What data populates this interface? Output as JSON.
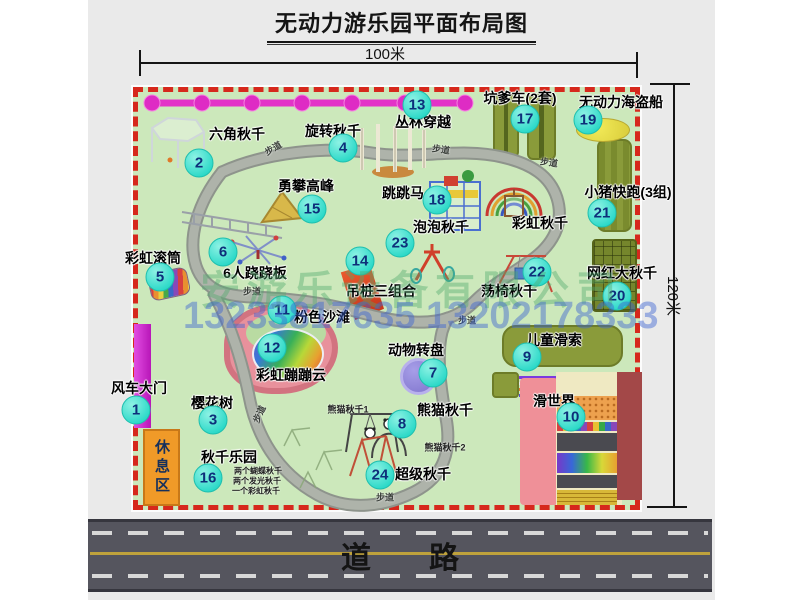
{
  "title": "无动力游乐园平面布局图",
  "dimensions": {
    "width_label": "100米",
    "height_label": "120米"
  },
  "road": {
    "label": "道路"
  },
  "rest_area": {
    "label": "休息区"
  },
  "watermark": {
    "company": "安游乐设备有限公司",
    "phones": "13233817635 13202178333"
  },
  "colors": {
    "map_green": "#cce8bb",
    "border_red": "#d6281c",
    "marker_teal": "#2cd9c8",
    "chain_pink": "#e332c8",
    "gate_magenta": "#b816b8",
    "rest_orange": "#f09a28",
    "road_gray": "#55555e",
    "watermark_green": "rgba(80,170,110,0.42)",
    "watermark_blue": "rgba(60,100,210,0.45)"
  },
  "attractions": [
    {
      "num": "1",
      "name": "风车大门",
      "circle": [
        136,
        410
      ],
      "label": [
        139,
        388
      ]
    },
    {
      "num": "2",
      "name": "六角秋千",
      "circle": [
        199,
        163
      ],
      "label": [
        237,
        134
      ]
    },
    {
      "num": "3",
      "name": "樱花树",
      "circle": [
        213,
        420
      ],
      "label": [
        212,
        403
      ]
    },
    {
      "num": "4",
      "name": "旋转秋千",
      "circle": [
        343,
        148
      ],
      "label": [
        333,
        131
      ]
    },
    {
      "num": "5",
      "name": "彩虹滚筒",
      "circle": [
        160,
        277
      ],
      "label": [
        153,
        258
      ]
    },
    {
      "num": "6",
      "name": "6人跷跷板",
      "circle": [
        223,
        252
      ],
      "label": [
        255,
        273
      ]
    },
    {
      "num": "7",
      "name": "动物转盘",
      "circle": [
        433,
        373
      ],
      "label": [
        416,
        350
      ]
    },
    {
      "num": "8",
      "name": "熊猫秋千",
      "circle": [
        402,
        424
      ],
      "label": [
        445,
        410
      ]
    },
    {
      "num": "9",
      "name": "儿童滑索",
      "circle": [
        527,
        357
      ],
      "label": [
        554,
        340
      ]
    },
    {
      "num": "10",
      "name": "滑世界",
      "circle": [
        571,
        417
      ],
      "label": [
        554,
        401
      ]
    },
    {
      "num": "11",
      "name": "粉色沙滩",
      "circle": [
        282,
        310
      ],
      "label": [
        322,
        317
      ]
    },
    {
      "num": "12",
      "name": "彩虹蹦蹦云",
      "circle": [
        272,
        348
      ],
      "label": [
        291,
        375
      ]
    },
    {
      "num": "13",
      "name": "丛林穿越",
      "circle": [
        417,
        105
      ],
      "label": [
        423,
        122
      ]
    },
    {
      "num": "14",
      "name": "吊桩三组合",
      "circle": [
        360,
        261
      ],
      "label": [
        381,
        291
      ]
    },
    {
      "num": "15",
      "name": "勇攀高峰",
      "circle": [
        312,
        209
      ],
      "label": [
        306,
        186
      ]
    },
    {
      "num": "16",
      "name": "秋千乐园",
      "circle": [
        208,
        478
      ],
      "label": [
        229,
        457
      ]
    },
    {
      "num": "17",
      "name": "坑爹车(2套)",
      "circle": [
        525,
        119
      ],
      "label": [
        520,
        98
      ]
    },
    {
      "num": "18",
      "name": "跳跳马",
      "circle": [
        437,
        200
      ],
      "label": [
        403,
        193
      ]
    },
    {
      "num": "19",
      "name": "无动力海盗船",
      "circle": [
        588,
        120
      ],
      "label": [
        621,
        102
      ]
    },
    {
      "num": "20",
      "name": "网红大秋千",
      "circle": [
        617,
        296
      ],
      "label": [
        622,
        273
      ]
    },
    {
      "num": "21",
      "name": "小猪快跑(3组)",
      "circle": [
        602,
        213
      ],
      "label": [
        628,
        192
      ]
    },
    {
      "num": "22",
      "name": "荡椅秋千",
      "circle": [
        537,
        272
      ],
      "label": [
        509,
        291
      ]
    },
    {
      "num": "23",
      "name": "泡泡秋千",
      "circle": [
        400,
        243
      ],
      "label": [
        441,
        227
      ]
    },
    {
      "num": "24",
      "name": "超级秋千",
      "circle": [
        380,
        475
      ],
      "label": [
        423,
        474
      ]
    },
    {
      "num": null,
      "name": "彩虹秋千",
      "circle": null,
      "label": [
        540,
        223
      ]
    }
  ],
  "notes": [
    {
      "text": "熊猫秋千1",
      "x": 348,
      "y": 409,
      "size": 9,
      "rot": 0
    },
    {
      "text": "熊猫秋千2",
      "x": 445,
      "y": 447,
      "size": 9,
      "rot": 0
    },
    {
      "text": "两个蝴蝶秋千",
      "x": 258,
      "y": 471,
      "size": 8,
      "rot": 0
    },
    {
      "text": "两个发光秋千",
      "x": 257,
      "y": 481,
      "size": 8,
      "rot": 0
    },
    {
      "text": "一个彩虹秋千",
      "x": 256,
      "y": 491,
      "size": 8,
      "rot": 0
    }
  ],
  "walkway_label": "步道",
  "walkway_labels": [
    {
      "x": 273,
      "y": 148,
      "rot": -30
    },
    {
      "x": 441,
      "y": 149,
      "rot": 8
    },
    {
      "x": 549,
      "y": 162,
      "rot": 8
    },
    {
      "x": 252,
      "y": 291,
      "rot": 0
    },
    {
      "x": 467,
      "y": 320,
      "rot": 0
    },
    {
      "x": 259,
      "y": 414,
      "rot": -65
    },
    {
      "x": 385,
      "y": 497,
      "rot": 0
    }
  ]
}
